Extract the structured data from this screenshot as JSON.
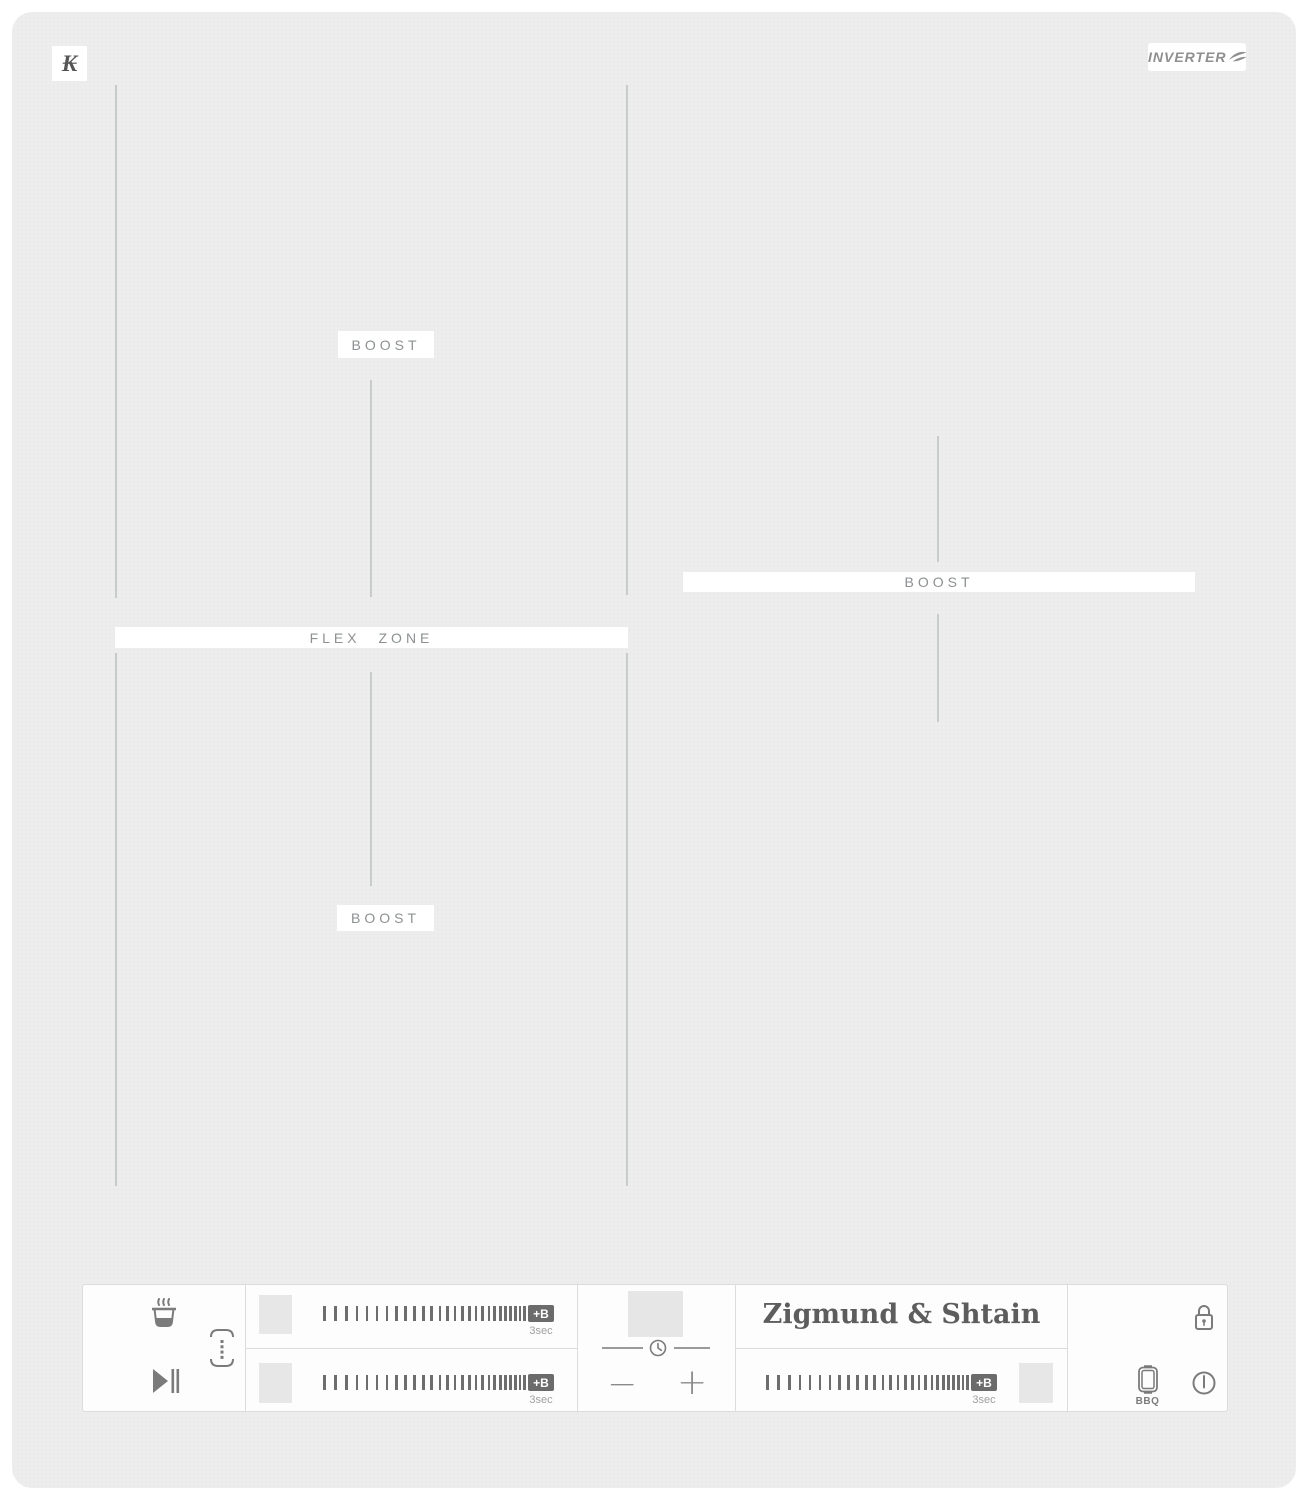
{
  "brand": {
    "monogram": "₭",
    "inverter": "INVERTER",
    "logo": "Zigmund & Shtain"
  },
  "zone_labels": {
    "flex": "FLEX ZONE",
    "boost_top_left": "BOOST",
    "boost_bottom_left": "BOOST",
    "boost_right": "BOOST"
  },
  "panel": {
    "boost_badge": "+B",
    "boost_hint": "3sec",
    "bbq": "BBQ",
    "minus": "−",
    "plus": "+",
    "slider": {
      "tick_count": 27
    },
    "icons": [
      "warm-pot",
      "bridge-flex",
      "play-pause",
      "timer-clock",
      "lock",
      "bbq",
      "power"
    ]
  },
  "colors": {
    "surface": "#ededed",
    "zone_line": "#c7cbca",
    "label_bg": "#ffffff",
    "label_text": "#8d9192",
    "panel_bg": "#fdfdfd",
    "panel_border": "#dcdcdc",
    "icon": "#7b7b7b",
    "tick": "#6d6d6d",
    "badge_bg": "#6b6b6b",
    "badge_text": "#ffffff",
    "pad": "#e7e7e7",
    "hint": "#a0a0a0",
    "logo_text": "#5d5d5d",
    "inverter_text": "#8f8f8f"
  }
}
